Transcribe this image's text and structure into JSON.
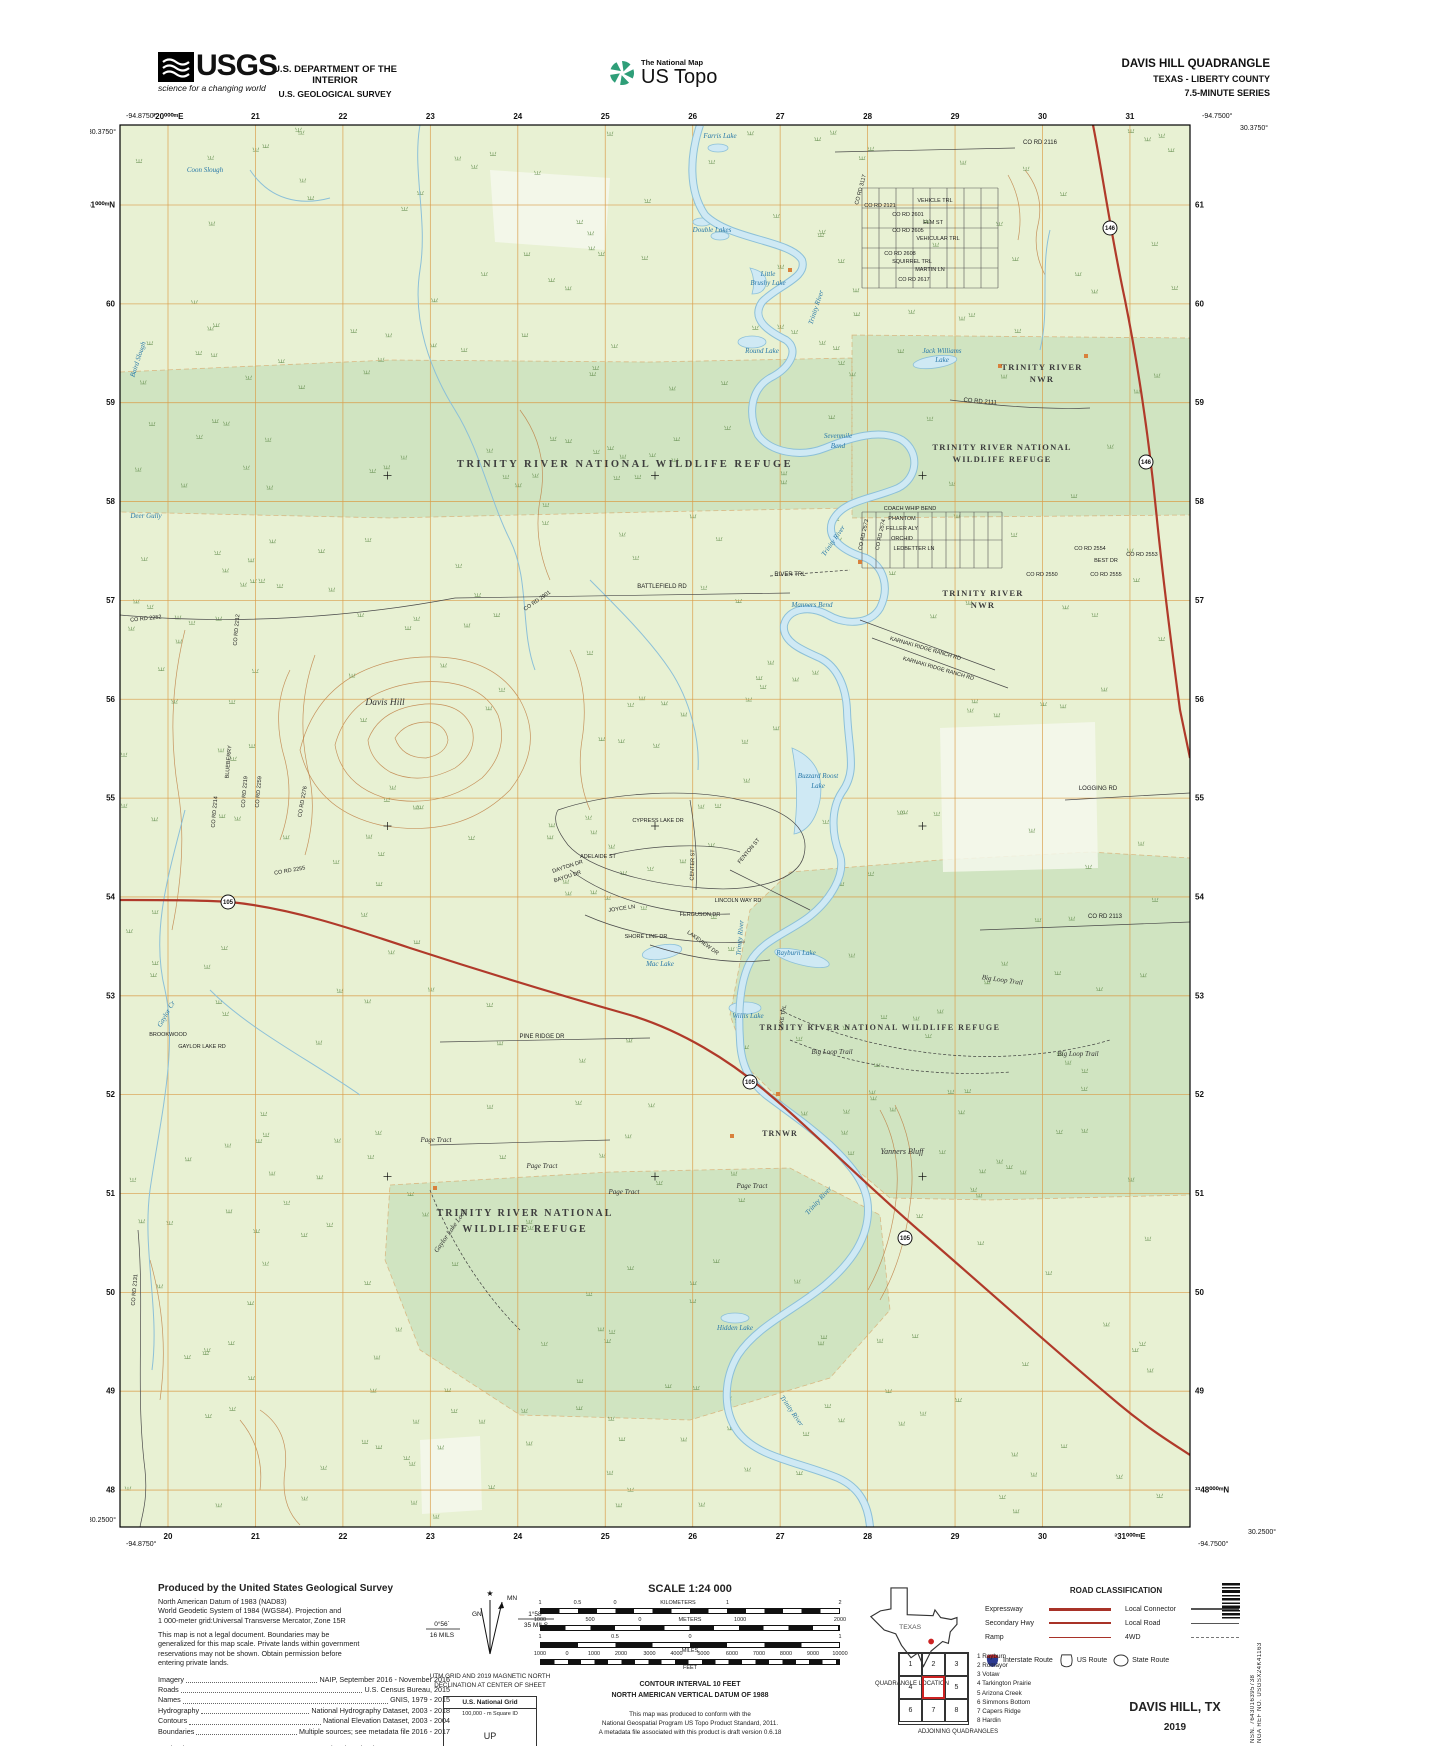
{
  "header": {
    "agency": "USGS",
    "tagline": "science for a changing world",
    "dept_line1": "U.S. DEPARTMENT OF THE INTERIOR",
    "dept_line2": "U.S. GEOLOGICAL SURVEY",
    "tnm": "The National Map",
    "ustopo": "US Topo",
    "quad_title": "DAVIS HILL QUADRANGLE",
    "quad_state": "TEXAS - LIBERTY COUNTY",
    "quad_series": "7.5-MINUTE SERIES"
  },
  "map": {
    "corners": {
      "tl_lon": "-94.8750°",
      "tl_lat": "30.3750°",
      "tr_lon": "-94.7500°",
      "tr_lat": "30.3750°",
      "bl_lat": "30.2500°",
      "bl_lon": "-94.8750°",
      "br_lon": "-94.7500°",
      "br_lat": "30.2500°"
    },
    "grid": {
      "eastings_top": [
        "³20⁰⁰⁰ᵐE",
        "21",
        "22",
        "23",
        "24",
        "25",
        "26",
        "27",
        "28",
        "29",
        "30",
        "31"
      ],
      "eastings_bottom": [
        "20",
        "21",
        "22",
        "23",
        "24",
        "25",
        "26",
        "27",
        "28",
        "29",
        "30",
        "³31⁰⁰⁰ᵐE"
      ],
      "northings_left": [
        "³³61⁰⁰⁰ᵐN",
        "60",
        "59",
        "58",
        "57",
        "56",
        "55",
        "54",
        "53",
        "52",
        "51",
        "50",
        "49",
        "48"
      ],
      "northings_right": [
        "61",
        "60",
        "59",
        "58",
        "57",
        "56",
        "55",
        "54",
        "53",
        "52",
        "51",
        "50",
        "49",
        "³³48⁰⁰⁰ᵐN"
      ]
    },
    "shields": [
      {
        "t": "146",
        "x": 1020,
        "y": 118
      },
      {
        "t": "146",
        "x": 1056,
        "y": 352
      },
      {
        "t": "105",
        "x": 138,
        "y": 792
      },
      {
        "t": "105",
        "x": 660,
        "y": 972
      },
      {
        "t": "105",
        "x": 815,
        "y": 1128
      }
    ],
    "buildings": [
      [
        688,
        984
      ],
      [
        642,
        1026
      ],
      [
        345,
        1078
      ],
      [
        910,
        256
      ],
      [
        996,
        246
      ],
      [
        770,
        452
      ],
      [
        700,
        160
      ]
    ],
    "labels": [
      {
        "t": "Coon Slough",
        "x": 115,
        "y": 62,
        "c": "w"
      },
      {
        "t": "Farris Lake",
        "x": 630,
        "y": 28,
        "c": "w"
      },
      {
        "t": "Double Lakes",
        "x": 622,
        "y": 122,
        "c": "w"
      },
      {
        "t": "Trinity River",
        "x": 728,
        "y": 198,
        "c": "w",
        "r": -72
      },
      {
        "t": "Little",
        "x": 678,
        "y": 166,
        "c": "w"
      },
      {
        "t": "Brushy Lake",
        "x": 678,
        "y": 175,
        "c": "w"
      },
      {
        "t": "Round Lake",
        "x": 672,
        "y": 243,
        "c": "w"
      },
      {
        "t": "Jack Williams",
        "x": 852,
        "y": 243,
        "c": "w"
      },
      {
        "t": "Lake",
        "x": 852,
        "y": 252,
        "c": "w"
      },
      {
        "t": "Baird Slough",
        "x": 50,
        "y": 250,
        "c": "w",
        "r": -72
      },
      {
        "t": "Sevenmile",
        "x": 748,
        "y": 328,
        "c": "w"
      },
      {
        "t": "Bend",
        "x": 748,
        "y": 338,
        "c": "w"
      },
      {
        "t": "Trinity River",
        "x": 745,
        "y": 432,
        "c": "w",
        "r": -55
      },
      {
        "t": "Deer Gully",
        "x": 56,
        "y": 408,
        "c": "w"
      },
      {
        "t": "Manners Bend",
        "x": 722,
        "y": 497,
        "c": "w"
      },
      {
        "t": "Buzzard Roost",
        "x": 728,
        "y": 668,
        "c": "w"
      },
      {
        "t": "Lake",
        "x": 728,
        "y": 678,
        "c": "w"
      },
      {
        "t": "Trinity River",
        "x": 652,
        "y": 828,
        "c": "w",
        "r": -85
      },
      {
        "t": "Rayburn Lake",
        "x": 706,
        "y": 845,
        "c": "w"
      },
      {
        "t": "Mac Lake",
        "x": 570,
        "y": 856,
        "c": "w"
      },
      {
        "t": "Willis Lake",
        "x": 658,
        "y": 908,
        "c": "w"
      },
      {
        "t": "Gaylor Cr",
        "x": 78,
        "y": 905,
        "c": "w",
        "r": -60
      },
      {
        "t": "Trinity River",
        "x": 730,
        "y": 1092,
        "c": "w",
        "r": -48
      },
      {
        "t": "Trinity River",
        "x": 700,
        "y": 1302,
        "c": "w",
        "r": 55
      },
      {
        "t": "Hidden Lake",
        "x": 645,
        "y": 1220,
        "c": "w"
      },
      {
        "t": "Davis Hill",
        "x": 295,
        "y": 595,
        "c": "P"
      },
      {
        "t": "Yanners Bluff",
        "x": 812,
        "y": 1044,
        "c": "p"
      },
      {
        "t": "TRINITY RIVER NATIONAL WILDLIFE REFUGE",
        "x": 535,
        "y": 357,
        "c": "R"
      },
      {
        "t": "TRINITY RIVER",
        "x": 952,
        "y": 260,
        "c": "r2"
      },
      {
        "t": "NWR",
        "x": 952,
        "y": 272,
        "c": "r2"
      },
      {
        "t": "TRINITY RIVER NATIONAL",
        "x": 912,
        "y": 340,
        "c": "r2"
      },
      {
        "t": "WILDLIFE REFUGE",
        "x": 912,
        "y": 352,
        "c": "r2"
      },
      {
        "t": "TRINITY RIVER",
        "x": 893,
        "y": 486,
        "c": "r2"
      },
      {
        "t": "NWR",
        "x": 893,
        "y": 498,
        "c": "r2"
      },
      {
        "t": "TRINITY RIVER NATIONAL WILDLIFE REFUGE",
        "x": 790,
        "y": 920,
        "c": "r3"
      },
      {
        "t": "TRINITY RIVER NATIONAL",
        "x": 435,
        "y": 1106,
        "c": "R2"
      },
      {
        "t": "WILDLIFE REFUGE",
        "x": 435,
        "y": 1122,
        "c": "R2"
      },
      {
        "t": "TRNWR",
        "x": 690,
        "y": 1026,
        "c": "r4"
      },
      {
        "t": "CO RD 3117",
        "x": 772,
        "y": 80,
        "c": "rs",
        "r": -75
      },
      {
        "t": "CO RD 2121",
        "x": 790,
        "y": 97,
        "c": "rs"
      },
      {
        "t": "VEHICLE TRL",
        "x": 845,
        "y": 92,
        "c": "rs"
      },
      {
        "t": "CO RD 2601",
        "x": 818,
        "y": 106,
        "c": "rs"
      },
      {
        "t": "ELM ST",
        "x": 843,
        "y": 114,
        "c": "rs"
      },
      {
        "t": "CO RD 2605",
        "x": 818,
        "y": 122,
        "c": "rs"
      },
      {
        "t": "VEHICULAR TRL",
        "x": 848,
        "y": 130,
        "c": "rs"
      },
      {
        "t": "CO RD 2608",
        "x": 810,
        "y": 145,
        "c": "rs"
      },
      {
        "t": "SQUIRREL TRL",
        "x": 822,
        "y": 153,
        "c": "rs"
      },
      {
        "t": "MARTIN LN",
        "x": 840,
        "y": 161,
        "c": "rs"
      },
      {
        "t": "CO RD 2617",
        "x": 824,
        "y": 171,
        "c": "rs"
      },
      {
        "t": "CO RD 2116",
        "x": 950,
        "y": 34,
        "c": "rd"
      },
      {
        "t": "CO RD 2111",
        "x": 890,
        "y": 293,
        "c": "rd",
        "r": 5
      },
      {
        "t": "COACH WHIP BEND",
        "x": 820,
        "y": 400,
        "c": "rs"
      },
      {
        "t": "PHANTOM",
        "x": 812,
        "y": 410,
        "c": "rs"
      },
      {
        "t": "FELLER ALY",
        "x": 812,
        "y": 420,
        "c": "rs"
      },
      {
        "t": "ORCHID",
        "x": 812,
        "y": 430,
        "c": "rs"
      },
      {
        "t": "LEDBETTER LN",
        "x": 824,
        "y": 440,
        "c": "rs"
      },
      {
        "t": "CO RD 2573",
        "x": 775,
        "y": 425,
        "c": "rs",
        "r": -78
      },
      {
        "t": "CO RD 2574",
        "x": 792,
        "y": 425,
        "c": "rs",
        "r": -78
      },
      {
        "t": "CO RD 2554",
        "x": 1000,
        "y": 440,
        "c": "rs"
      },
      {
        "t": "BEST DR",
        "x": 1016,
        "y": 452,
        "c": "rs"
      },
      {
        "t": "CO RD 2553",
        "x": 1052,
        "y": 446,
        "c": "rs"
      },
      {
        "t": "CO RD 2550",
        "x": 952,
        "y": 466,
        "c": "rs"
      },
      {
        "t": "CO RD 2555",
        "x": 1016,
        "y": 466,
        "c": "rs"
      },
      {
        "t": "RIVER TRL",
        "x": 700,
        "y": 466,
        "c": "rd"
      },
      {
        "t": "BATTLEFIELD RD",
        "x": 572,
        "y": 478,
        "c": "rd"
      },
      {
        "t": "KARNAKI RIDGE RANCH RD",
        "x": 835,
        "y": 540,
        "c": "rs",
        "r": 16
      },
      {
        "t": "KARNAKI RIDGE RANCH RD",
        "x": 848,
        "y": 560,
        "c": "rs",
        "r": 16
      },
      {
        "t": "CO RD 2252",
        "x": 56,
        "y": 510,
        "c": "rs",
        "r": -6
      },
      {
        "t": "CO RD 2212",
        "x": 148,
        "y": 520,
        "c": "rs",
        "r": -85
      },
      {
        "t": "CO RD 2901",
        "x": 448,
        "y": 492,
        "c": "rs",
        "r": -35
      },
      {
        "t": "BLUEBERRY",
        "x": 140,
        "y": 652,
        "c": "rs",
        "r": -85
      },
      {
        "t": "CO RD 2219",
        "x": 156,
        "y": 682,
        "c": "rs",
        "r": -85
      },
      {
        "t": "CO RD 2259",
        "x": 170,
        "y": 682,
        "c": "rs",
        "r": -85
      },
      {
        "t": "CO RD 2214",
        "x": 126,
        "y": 702,
        "c": "rs",
        "r": -85
      },
      {
        "t": "CO RD 2276",
        "x": 214,
        "y": 692,
        "c": "rs",
        "r": -80
      },
      {
        "t": "CO RD 2255",
        "x": 200,
        "y": 762,
        "c": "rs",
        "r": -10
      },
      {
        "t": "LOGGING RD",
        "x": 1008,
        "y": 680,
        "c": "rd"
      },
      {
        "t": "CO RD 2113",
        "x": 1015,
        "y": 808,
        "c": "rd"
      },
      {
        "t": "CYPRESS LAKE DR",
        "x": 568,
        "y": 712,
        "c": "rs"
      },
      {
        "t": "ADELAIDE ST",
        "x": 508,
        "y": 748,
        "c": "rs"
      },
      {
        "t": "CENTER ST",
        "x": 604,
        "y": 755,
        "c": "rs",
        "r": -88
      },
      {
        "t": "FENTON ST",
        "x": 660,
        "y": 742,
        "c": "rs",
        "r": -50
      },
      {
        "t": "LINCOLN WAY RD",
        "x": 648,
        "y": 792,
        "c": "rs"
      },
      {
        "t": "FERGUSON DR",
        "x": 610,
        "y": 806,
        "c": "rs"
      },
      {
        "t": "DAYTON DR",
        "x": 478,
        "y": 758,
        "c": "rs",
        "r": -18
      },
      {
        "t": "BAYOU DR",
        "x": 478,
        "y": 768,
        "c": "rs",
        "r": -18
      },
      {
        "t": "JOYCE LN",
        "x": 532,
        "y": 800,
        "c": "rs",
        "r": -8
      },
      {
        "t": "SHORE LINE DR",
        "x": 556,
        "y": 828,
        "c": "rs"
      },
      {
        "t": "LAKEVIEW DR",
        "x": 612,
        "y": 834,
        "c": "rs",
        "r": 36
      },
      {
        "t": "PINE RIDGE DR",
        "x": 452,
        "y": 928,
        "c": "rd"
      },
      {
        "t": "BROOKWOOD",
        "x": 78,
        "y": 926,
        "c": "rs"
      },
      {
        "t": "GAYLOR LAKE RD",
        "x": 112,
        "y": 938,
        "c": "rs"
      },
      {
        "t": "Big Loop Trail",
        "x": 912,
        "y": 872,
        "c": "tr",
        "r": 8
      },
      {
        "t": "Big Loop Trail",
        "x": 742,
        "y": 944,
        "c": "tr"
      },
      {
        "t": "Big Loop Trail",
        "x": 988,
        "y": 946,
        "c": "tr"
      },
      {
        "t": "LAKE TRL",
        "x": 694,
        "y": 908,
        "c": "rs",
        "r": -80
      },
      {
        "t": "Page Tract",
        "x": 346,
        "y": 1032,
        "c": "tr"
      },
      {
        "t": "Page Tract",
        "x": 452,
        "y": 1058,
        "c": "tr"
      },
      {
        "t": "Page Tract",
        "x": 534,
        "y": 1084,
        "c": "tr"
      },
      {
        "t": "Page Tract",
        "x": 662,
        "y": 1078,
        "c": "tr"
      },
      {
        "t": "Gaylor Lake Loop",
        "x": 362,
        "y": 1122,
        "c": "tr",
        "r": -55
      },
      {
        "t": "CO RD 2131",
        "x": 46,
        "y": 1180,
        "c": "rs",
        "r": -85
      }
    ]
  },
  "footer": {
    "produced_by": {
      "title": "Produced by the United States Geological Survey",
      "lines": [
        "North American Datum of 1983 (NAD83)",
        "World Geodetic System of 1984 (WGS84).  Projection and",
        "1 000-meter grid:Universal Transverse Mercator, Zone 15R"
      ],
      "disclaimer": [
        "This map is not a legal document. Boundaries may be",
        "generalized for this map scale. Private lands within government",
        "reservations may not be shown. Obtain permission before",
        "entering private lands."
      ],
      "sources": [
        {
          "label": "Imagery",
          "value": "NAIP, September 2016 - November 2016"
        },
        {
          "label": "Roads",
          "value": "U.S. Census Bureau, 2015"
        },
        {
          "label": "Names",
          "value": "GNIS, 1979 - 2015"
        },
        {
          "label": "Hydrography",
          "value": "National Hydrography Dataset, 2003 - 2018"
        },
        {
          "label": "Contours",
          "value": "National Elevation Dataset, 2003 - 2004"
        },
        {
          "label": "Boundaries",
          "value": "Multiple sources; see metadata file 2016 - 2017"
        },
        {
          "label": "Wetlands",
          "value": "FWS National Wetlands Inventory 1993 - 2006",
          "gap": true
        }
      ]
    },
    "declination": {
      "mn": "MN",
      "gn": "GN",
      "gn_deg": "0°56´",
      "gn_mils": "16 MILS",
      "mn_deg": "1°58´",
      "mn_mils": "35 MILS",
      "caption": [
        "UTM GRID AND 2019 MAGNETIC NORTH",
        "DECLINATION AT CENTER OF SHEET"
      ]
    },
    "usng": {
      "title": "U.S. National Grid",
      "sq": "100,000 - m Square ID",
      "square": "UP",
      "zone_label": "Grid Zone Designation",
      "zone": "15R"
    },
    "scale": {
      "title": "SCALE 1:24 000",
      "rows": [
        {
          "bar": "bar-km",
          "ticks": [
            {
              "t": "1",
              "p": 0
            },
            {
              "t": "0.5",
              "p": 12.5
            },
            {
              "t": "0",
              "p": 25
            },
            {
              "t": "KILOMETERS",
              "p": 46
            },
            {
              "t": "1",
              "p": 62.5
            },
            {
              "t": "2",
              "p": 100
            }
          ]
        },
        {
          "bar": "bar-m",
          "ticks": [
            {
              "t": "1000",
              "p": 0
            },
            {
              "t": "500",
              "p": 16.7
            },
            {
              "t": "0",
              "p": 33.3
            },
            {
              "t": "METERS",
              "p": 50
            },
            {
              "t": "1000",
              "p": 66.7
            },
            {
              "t": "2000",
              "p": 100
            }
          ]
        },
        {
          "bar": "bar-mi",
          "ticks": [
            {
              "t": "1",
              "p": 0
            },
            {
              "t": "0.5",
              "p": 25
            },
            {
              "t": "0",
              "p": 50
            },
            {
              "t": "1",
              "p": 100
            }
          ],
          "under": "MILES"
        },
        {
          "bar": "bar-ft",
          "ticks": [
            {
              "t": "1000",
              "p": 0
            },
            {
              "t": "0",
              "p": 9
            },
            {
              "t": "1000",
              "p": 18
            },
            {
              "t": "2000",
              "p": 27
            },
            {
              "t": "3000",
              "p": 36.5
            },
            {
              "t": "4000",
              "p": 45.5
            },
            {
              "t": "5000",
              "p": 54.5
            },
            {
              "t": "6000",
              "p": 64
            },
            {
              "t": "7000",
              "p": 73
            },
            {
              "t": "8000",
              "p": 82
            },
            {
              "t": "9000",
              "p": 91
            },
            {
              "t": "10000",
              "p": 100
            }
          ],
          "under": "FEET"
        }
      ]
    },
    "contour": [
      "CONTOUR INTERVAL 10 FEET",
      "NORTH AMERICAN VERTICAL DATUM OF 1988"
    ],
    "standard": [
      "This map was produced to conform with the",
      "National Geospatial Program US Topo Product Standard, 2011.",
      "A metadata file associated with this product is draft version 0.6.18"
    ],
    "quad_location": {
      "caption": "QUADRANGLE LOCATION",
      "state": "TEXAS"
    },
    "road_class": {
      "title": "ROAD CLASSIFICATION",
      "left": [
        {
          "label": "Expressway",
          "cls": "ln-exp"
        },
        {
          "label": "Secondary Hwy",
          "cls": "ln-sec"
        },
        {
          "label": "Ramp",
          "cls": "ln-ramp"
        }
      ],
      "right": [
        {
          "label": "Local Connector",
          "cls": "ln-lc"
        },
        {
          "label": "Local Road",
          "cls": "ln-lr"
        },
        {
          "label": "4WD",
          "cls": "ln-4wd"
        }
      ],
      "shields": [
        {
          "label": "Interstate Route"
        },
        {
          "label": "US Route"
        },
        {
          "label": "State Route"
        }
      ]
    },
    "adjoining": {
      "cells": [
        "1",
        "2",
        "3",
        "4",
        "",
        "5",
        "6",
        "7",
        "8"
      ],
      "names": [
        "1 Rayburn",
        "2 Romayor",
        "3 Votaw",
        "4 Tarkington Prairie",
        "5 Arizona Creek",
        "6 Simmons Bottom",
        "7 Capers Ridge",
        "8 Hardin"
      ],
      "caption": "ADJOINING QUADRANGLES"
    },
    "title_block": {
      "name": "DAVIS HILL,  TX",
      "year": "2019"
    },
    "nsn": "NSN. 7643016395738",
    "nga": "NGA REF NO. USGSX24K41163"
  }
}
